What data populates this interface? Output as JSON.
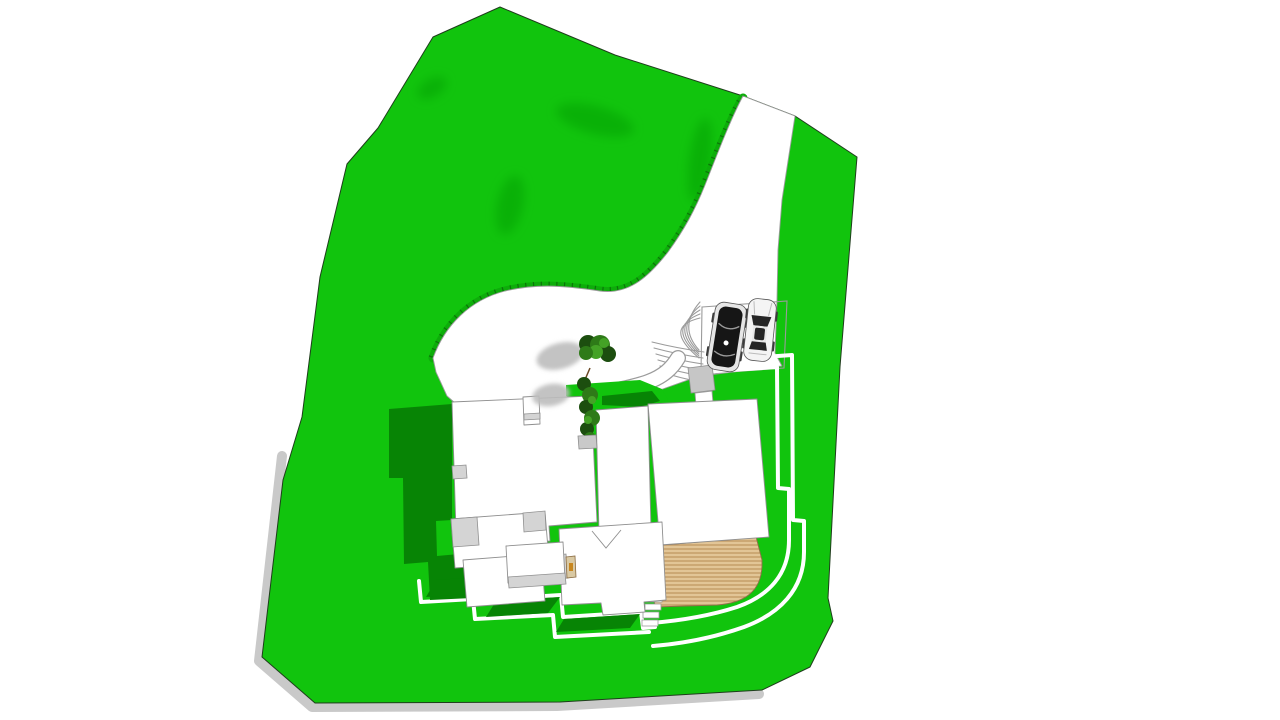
{
  "scene": {
    "title": "3d-site-plan-render",
    "description": "Top-down 3D rendering of a hillside residential lot: green terrain, curved driveway from top edge, parking pad with two cars, fanned entry steps, S-curved walkway, flat-roofed house with multiple roof levels, wooden deck with rounded corner, terraced garden walls and two trees casting shadows.",
    "canvas": {
      "width": 1280,
      "height": 720,
      "background": "#ffffff"
    },
    "colors": {
      "background": "#ffffff",
      "grass": "#11c40d",
      "grass_shadow": "#078405",
      "terrain_smudge": "#089906",
      "slope_band": "#0dad0a",
      "slope_line": "#0a3d08",
      "lot_outline": "#1f3d1c",
      "lot_base_gray": "#c9c9c9",
      "paving": "#ffffff",
      "paving_edge": "#9b9b9b",
      "roof_white": "#ffffff",
      "roof_gray": "#d4d4d4",
      "roof_edge": "#8f8f8f",
      "landing_gray": "#c6c6c6",
      "planter_gray": "#c9c9c9",
      "deck_wood": "#e2c596",
      "deck_line": "#bb9059",
      "deck_edge": "#8f7048",
      "door_tan": "#d9c9a3",
      "door_accent": "#c8861e",
      "tree_dark": "#1c4e0f",
      "tree_mid": "#2e7a18",
      "tree_light": "#44a226",
      "tree_shadow": "#bcbcbc",
      "trunk": "#6b4a26",
      "car_black": "#161616",
      "car_white": "#f4f4f4",
      "car_glass": "#262626",
      "car_trim": "#e6e6e6"
    },
    "objects": [
      {
        "name": "site-lot",
        "kind": "grass terrain parcel",
        "shape": "irregular polygon"
      },
      {
        "name": "driveway",
        "kind": "paved drive entering from top edge, curving to parking pad"
      },
      {
        "name": "parking-pad",
        "kind": "paving with two parked cars"
      },
      {
        "name": "car-black",
        "kind": "dark sports car, top view"
      },
      {
        "name": "car-white",
        "kind": "white SUV with sunroof, top view"
      },
      {
        "name": "entry-steps",
        "kind": "two fans of concentric curved steps"
      },
      {
        "name": "walkway",
        "kind": "S-curved white path to front entry"
      },
      {
        "name": "house",
        "kind": "flat white roofs, chimney, gray roof patches"
      },
      {
        "name": "deck",
        "kind": "wood plank deck with rounded corner"
      },
      {
        "name": "garden-walls",
        "kind": "nested white terraced retaining walls"
      },
      {
        "name": "trees",
        "kind": "two dark-green trees with gray cast shadows"
      },
      {
        "name": "shadows",
        "kind": "dark green building shadows on lawn"
      }
    ]
  }
}
